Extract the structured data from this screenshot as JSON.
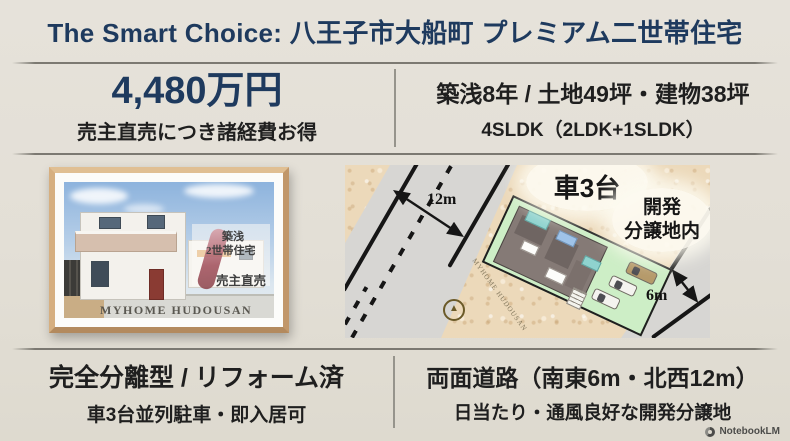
{
  "page_title": "The Smart Choice: 八王子市大船町 プレミアム二世帯住宅",
  "price_block": {
    "price": "4,480万円",
    "note": "売主直売につき諸経費お得"
  },
  "specs_block": {
    "heading": "築浅8年 / 土地49坪・建物38坪",
    "floor_plan": "4SLDK（2LDK+1SLDK）"
  },
  "photo_block": {
    "badge_age": "築浅",
    "badge_type": "2世帯住宅",
    "badge_sale": "売主直売",
    "watermark": "MYHOME HUDOUSAN"
  },
  "site_plan": {
    "north_road_width": "12m",
    "south_road_width": "6m",
    "parking_label": "車3台",
    "development_line1": "開発",
    "development_line2": "分譲地内",
    "watermark": "MYHOME HUDOUSAN",
    "compass_glyph": "▲"
  },
  "feature_left": {
    "heading": "完全分離型 / リフォーム済",
    "sub": "車3台並列駐車・即入居可"
  },
  "feature_right": {
    "heading": "両面道路（南東6m・北西12m）",
    "sub": "日当たり・通風良好な開発分譲地"
  },
  "footer": {
    "brand": "NotebookLM"
  },
  "colors": {
    "background": "#e3dfd6",
    "accent_navy": "#1e3a5e",
    "text_dark": "#1f1f1f",
    "divider_gray": "#96948c",
    "frame_wood": "#d3ab7d",
    "map_ground": "#ecd9ba",
    "plot_green": "#cdeec6",
    "road_gray": "#d7d6d3"
  }
}
